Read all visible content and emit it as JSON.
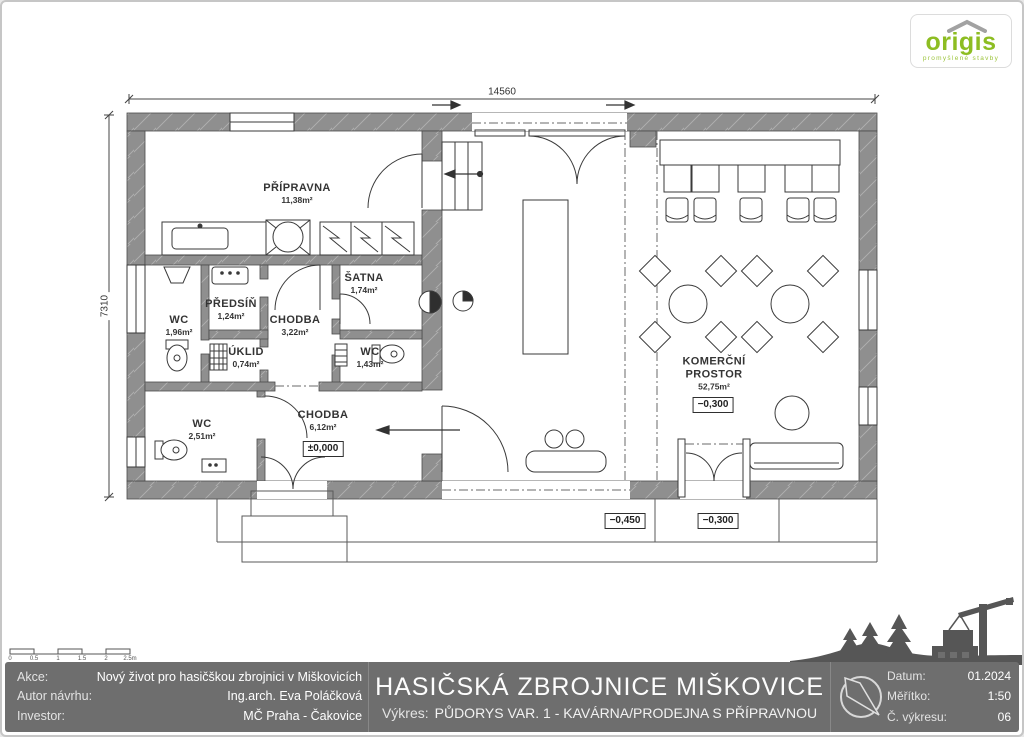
{
  "logo": {
    "text": "origis",
    "tagline": "promyšlené stavby",
    "green": "#8dbd22"
  },
  "dimensions": {
    "width": "14560",
    "height": "7310"
  },
  "rooms": {
    "pripravna": {
      "name": "PŘÍPRAVNA",
      "area": "11,38m²"
    },
    "wc1": {
      "name": "WC",
      "area": "1,96m²"
    },
    "predsin": {
      "name": "PŘEDSÍŇ",
      "area": "1,24m²"
    },
    "chodba1": {
      "name": "CHODBA",
      "area": "3,22m²"
    },
    "satna": {
      "name": "ŠATNA",
      "area": "1,74m²"
    },
    "uklid": {
      "name": "ÚKLID",
      "area": "0,74m²"
    },
    "wc2": {
      "name": "WC",
      "area": "1,43m²"
    },
    "wc3": {
      "name": "WC",
      "area": "2,51m²"
    },
    "chodba2": {
      "name": "CHODBA",
      "area": "6,12m²"
    },
    "komercni": {
      "name_line1": "KOMERČNÍ",
      "name_line2": "PROSTOR",
      "area": "52,75m²"
    }
  },
  "elevations": {
    "chodba": "±0,000",
    "komercni": "−0,300",
    "exterior_left": "−0,450",
    "exterior_right": "−0,300"
  },
  "scale_bar": {
    "ticks": [
      "0",
      "0.5",
      "1",
      "1.5",
      "2",
      "2.5m"
    ]
  },
  "title_block": {
    "project_label": "Akce:",
    "project_value": "Nový život pro hasičškou zbrojnici v Miškovicích",
    "author_label": "Autor návrhu:",
    "author_value": "Ing.arch. Eva Poláčková",
    "investor_label": "Investor:",
    "investor_value": "MČ Praha - Čakovice",
    "main_title": "HASIČSKÁ ZBROJNICE MIŠKOVICE",
    "drawing_label": "Výkres:",
    "drawing_value": "PŮDORYS VAR. 1 - KAVÁRNA/PRODEJNA S PŘÍPRAVNOU",
    "date_label": "Datum:",
    "date_value": "01.2024",
    "scale_label": "Měřítko:",
    "scale_value": "1:50",
    "number_label": "Č. výkresu:",
    "number_value": "06"
  }
}
